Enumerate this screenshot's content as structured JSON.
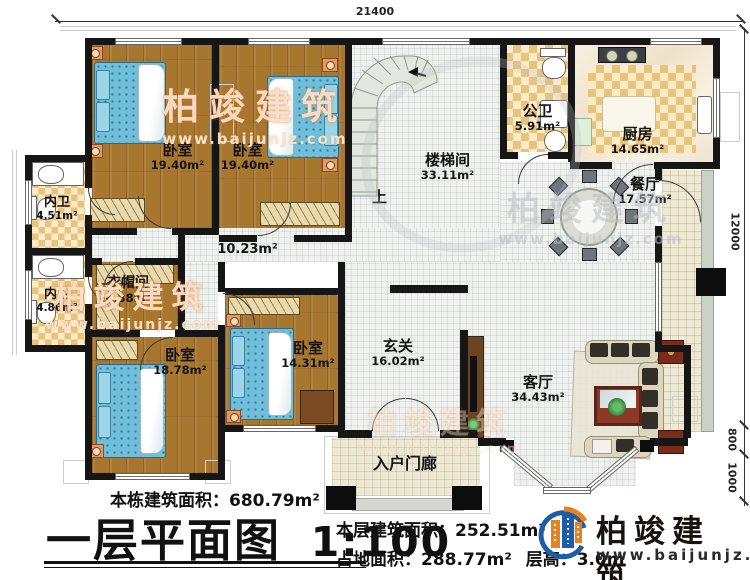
{
  "dimensions": {
    "top_width": "21400",
    "right_upper": "12000",
    "right_mid": "800",
    "right_lower": "1000"
  },
  "rooms": {
    "bedroom_tl": {
      "name": "卧室",
      "area": "19.40m²"
    },
    "bedroom_tr": {
      "name": "卧室",
      "area": "19.40m²"
    },
    "stairwell": {
      "name": "楼梯间",
      "area": "33.11m²"
    },
    "public_bath": {
      "name": "公卫",
      "area": "5.91m²"
    },
    "kitchen": {
      "name": "厨房",
      "area": "14.65m²"
    },
    "dining": {
      "name": "餐厅",
      "area": "17.57m²"
    },
    "inner_bath_1": {
      "name": "内卫",
      "area": "4.51m²"
    },
    "inner_bath_2": {
      "name": "内卫",
      "area": "4.86m²"
    },
    "cloakroom": {
      "name": "衣帽间",
      "area": "6.38m²"
    },
    "hallway": {
      "area": "10.23m²"
    },
    "bedroom_bl": {
      "name": "卧室",
      "area": "18.78m²"
    },
    "bedroom_bm": {
      "name": "卧室",
      "area": "14.31m²"
    },
    "foyer": {
      "name": "玄关",
      "area": "16.02m²"
    },
    "living": {
      "name": "客厅",
      "area": "34.43m²"
    },
    "porch": {
      "name": "入户门廊"
    }
  },
  "stairs": {
    "up_label": "上"
  },
  "title_block": {
    "total_label": "本栋建筑面积：",
    "total_value": "680.79m²",
    "plan_title": "一层平面图",
    "scale": "1:100",
    "floor_label": "本层建筑面积：",
    "floor_value": "252.51m²",
    "footprint_label": "占地面积：",
    "footprint_value": "288.77m²",
    "height_label": "层高：",
    "height_value": "3.0m"
  },
  "logo": {
    "name": "柏竣建筑",
    "url": "www.baijunjz.com"
  },
  "watermark": {
    "text": "柏竣建筑",
    "url": "www.baijunjz.com"
  },
  "colors": {
    "wall": "#161616",
    "wood_floor": "#a8772f",
    "checker_tile": "#e9c27c",
    "open_floor": "#eff1ef",
    "bed": "#6fbfdb",
    "logo_blue": "#1c5ca8",
    "logo_orange": "#e8821e"
  }
}
